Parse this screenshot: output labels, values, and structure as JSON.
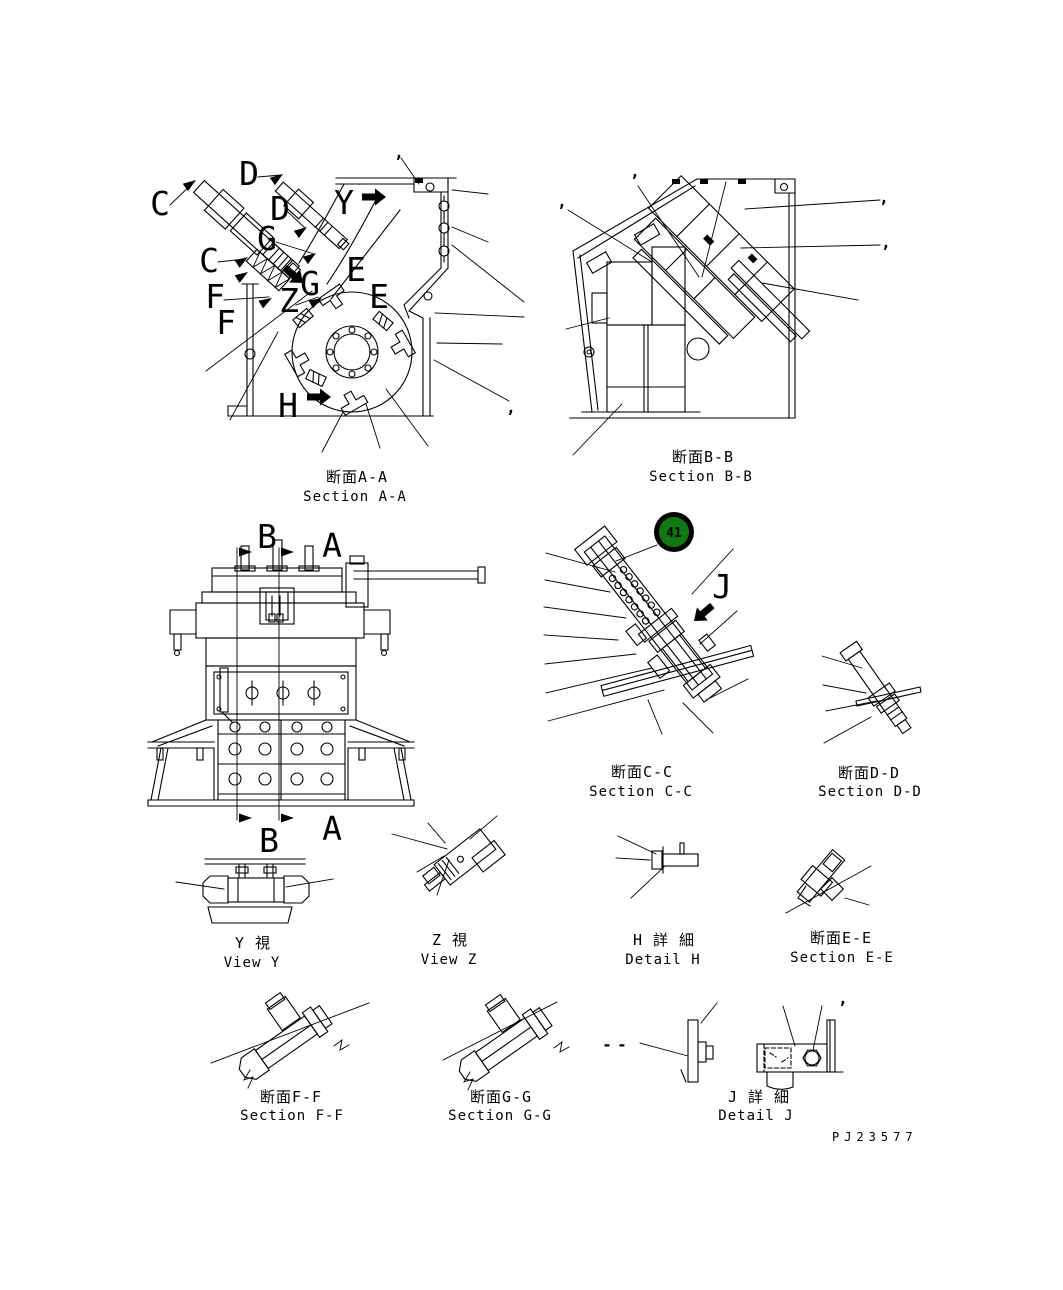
{
  "page": {
    "background": "#ffffff",
    "line_color": "#000000",
    "drawing_number": "PJ23577"
  },
  "highlight": {
    "value": "41",
    "fill": "#107a11",
    "ring": "#000000",
    "text_color": "#ffffff"
  },
  "callouts": {
    "blank": ",",
    "dash": "-"
  },
  "views": {
    "section_aa": {
      "caption_jp": "断面A-A",
      "caption_en": "Section A-A",
      "markers": {
        "c1": "C",
        "d1": "D",
        "d2": "D",
        "g1": "G",
        "c2": "C",
        "g2": "G",
        "e1": "E",
        "z1": "Z",
        "e2": "E",
        "f1": "F",
        "f2": "F",
        "y1": "Y",
        "h1": "H"
      }
    },
    "section_bb": {
      "caption_jp": "断面B-B",
      "caption_en": "Section B-B"
    },
    "front_view": {
      "markers": {
        "b_top": "B",
        "a_top": "A",
        "a_bottom": "A",
        "b_bottom": "B"
      }
    },
    "section_cc": {
      "caption_jp": "断面C-C",
      "caption_en": "Section C-C",
      "marker_j": "J"
    },
    "section_dd": {
      "caption_jp": "断面D-D",
      "caption_en": "Section D-D"
    },
    "view_y": {
      "caption_jp": "Y 視",
      "caption_en": "View Y"
    },
    "view_z": {
      "caption_jp": "Z 視",
      "caption_en": "View Z"
    },
    "detail_h": {
      "caption_jp": "H 詳 細",
      "caption_en": "Detail H"
    },
    "section_ee": {
      "caption_jp": "断面E-E",
      "caption_en": "Section E-E"
    },
    "section_ff": {
      "caption_jp": "断面F-F",
      "caption_en": "Section F-F"
    },
    "section_gg": {
      "caption_jp": "断面G-G",
      "caption_en": "Section G-G"
    },
    "detail_j": {
      "caption_jp": "J 詳 細",
      "caption_en": "Detail J"
    }
  }
}
